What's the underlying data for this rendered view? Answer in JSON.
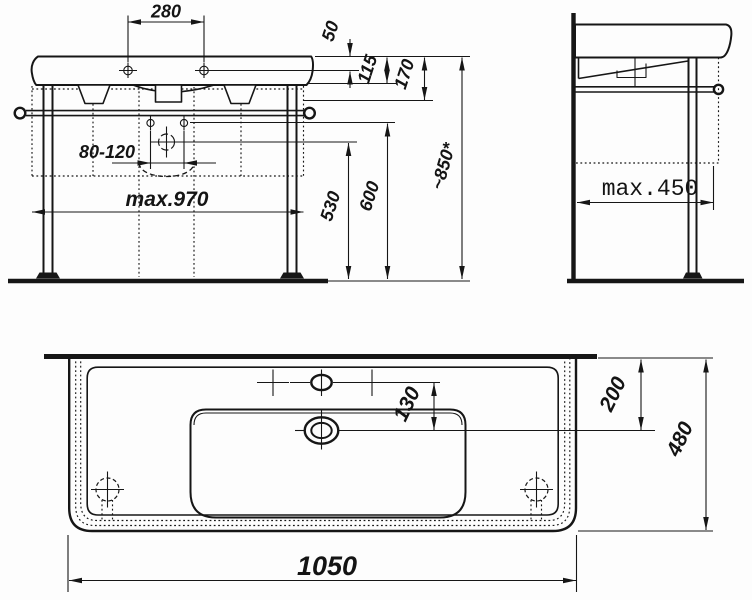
{
  "drawing": {
    "background": "#ffffff",
    "line_color": "#161616",
    "front_view": {
      "tap_spacing": "280",
      "rim_to_tap": "50",
      "rim_height": "115",
      "rim_to_rail": "170",
      "supply_spacing": "80-120",
      "frame_width": "max.970",
      "rail_height": "530",
      "drain_height": "600",
      "overall_height": "~850*"
    },
    "side_view": {
      "max_depth": "max.450"
    },
    "plan_view": {
      "faucet_to_drain": "130",
      "wall_to_drain": "200",
      "depth": "480",
      "width": "1050"
    }
  }
}
